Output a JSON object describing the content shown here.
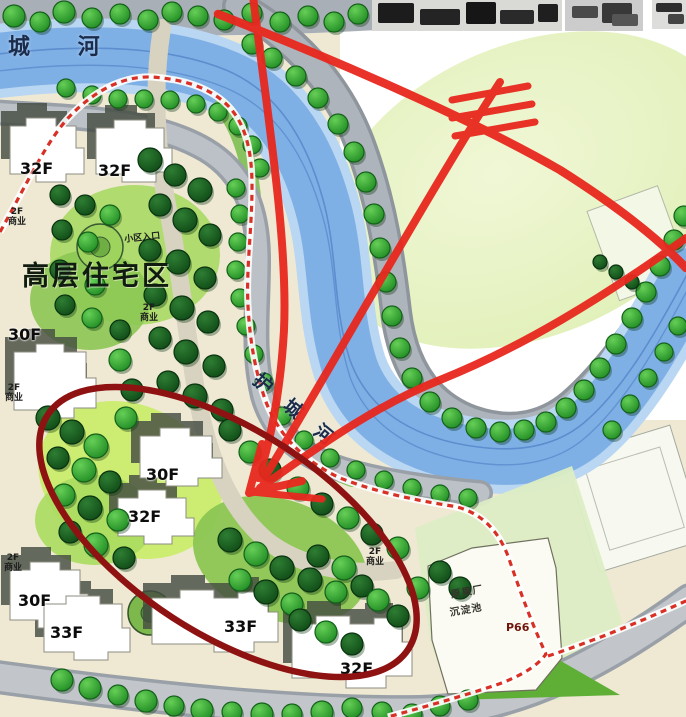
{
  "map_title": "residential-site-plan",
  "colors": {
    "site-cream": "#efe9d4",
    "road-gray": "#aeb4bb",
    "river-blue": "#7fb0e5",
    "tree-green": "#2f9e2f",
    "annotation-red": "#e8281e",
    "ellipse-maroon": "#8f1212",
    "boundary-red": "#d93025",
    "label-navy": "#1b2b4a"
  },
  "labels": [
    {
      "name": "river-label-top",
      "text": "城 河",
      "x": 8,
      "y": 36,
      "cls": "river-big"
    },
    {
      "name": "river-label-moat",
      "text": "护 城 河",
      "x": 262,
      "y": 370,
      "cls": "river-mid",
      "rot": 40
    },
    {
      "name": "district-label",
      "text": "高层住宅区",
      "x": 22,
      "y": 262,
      "cls": "area-big"
    },
    {
      "name": "entrance-label",
      "text": "小区入口",
      "x": 124,
      "y": 236,
      "cls": "tiny",
      "rot": -6
    },
    {
      "name": "commercial-label",
      "text": "2F\n商业",
      "x": 8,
      "y": 208,
      "cls": "tiny"
    },
    {
      "name": "commercial-label",
      "text": "2F\n商业",
      "x": 140,
      "y": 304,
      "cls": "tiny"
    },
    {
      "name": "commercial-label",
      "text": "2F\n商业",
      "x": 5,
      "y": 384,
      "cls": "tiny"
    },
    {
      "name": "commercial-label",
      "text": "2F\n商业",
      "x": 4,
      "y": 554,
      "cls": "tiny"
    },
    {
      "name": "commercial-label",
      "text": "2F\n商业",
      "x": 366,
      "y": 548,
      "cls": "tiny"
    },
    {
      "name": "floor-label",
      "text": "32F",
      "x": 20,
      "y": 160,
      "cls": "floor"
    },
    {
      "name": "floor-label",
      "text": "32F",
      "x": 98,
      "y": 162,
      "cls": "floor"
    },
    {
      "name": "floor-label",
      "text": "30F",
      "x": 8,
      "y": 326,
      "cls": "floor"
    },
    {
      "name": "floor-label",
      "text": "30F",
      "x": 146,
      "y": 466,
      "cls": "floor"
    },
    {
      "name": "floor-label",
      "text": "32F",
      "x": 128,
      "y": 508,
      "cls": "floor"
    },
    {
      "name": "floor-label",
      "text": "30F",
      "x": 18,
      "y": 592,
      "cls": "floor"
    },
    {
      "name": "floor-label",
      "text": "33F",
      "x": 50,
      "y": 624,
      "cls": "floor"
    },
    {
      "name": "floor-label",
      "text": "33F",
      "x": 224,
      "y": 618,
      "cls": "floor"
    },
    {
      "name": "floor-label",
      "text": "32F",
      "x": 340,
      "y": 660,
      "cls": "floor"
    },
    {
      "name": "factory-label",
      "text": "原果厂",
      "x": 450,
      "y": 590,
      "cls": "tiny2",
      "rot": -10
    },
    {
      "name": "factory-label",
      "text": "沉淀池",
      "x": 449,
      "y": 608,
      "cls": "tiny2",
      "rot": -10
    },
    {
      "name": "parking-label",
      "text": "P66",
      "x": 506,
      "y": 622,
      "cls": "p-label"
    }
  ]
}
